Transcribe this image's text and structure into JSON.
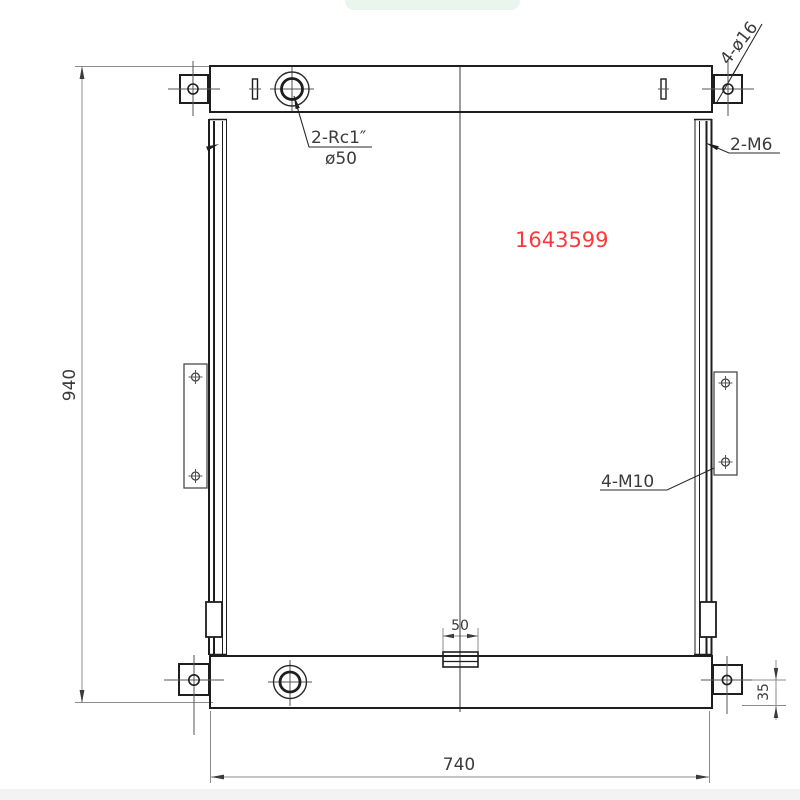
{
  "drawing": {
    "part_number": "1643599",
    "dimensions": {
      "overall_height": "940",
      "overall_width": "740",
      "drain_width": "50",
      "foot_hole_offset": "35"
    },
    "labels": {
      "top_port_thread": "2-Rc1″",
      "top_port_diameter": "ø50",
      "side_channel_thread": "2-M6",
      "corner_bracket_holes": "4-ø16",
      "side_plate_thread": "4-M10"
    },
    "colors": {
      "outline": "#1e1e1e",
      "dimension_lines": "#8c8c8c",
      "part_number_red": "#fa3a3a",
      "toast_green": "#e8f6ee"
    }
  }
}
